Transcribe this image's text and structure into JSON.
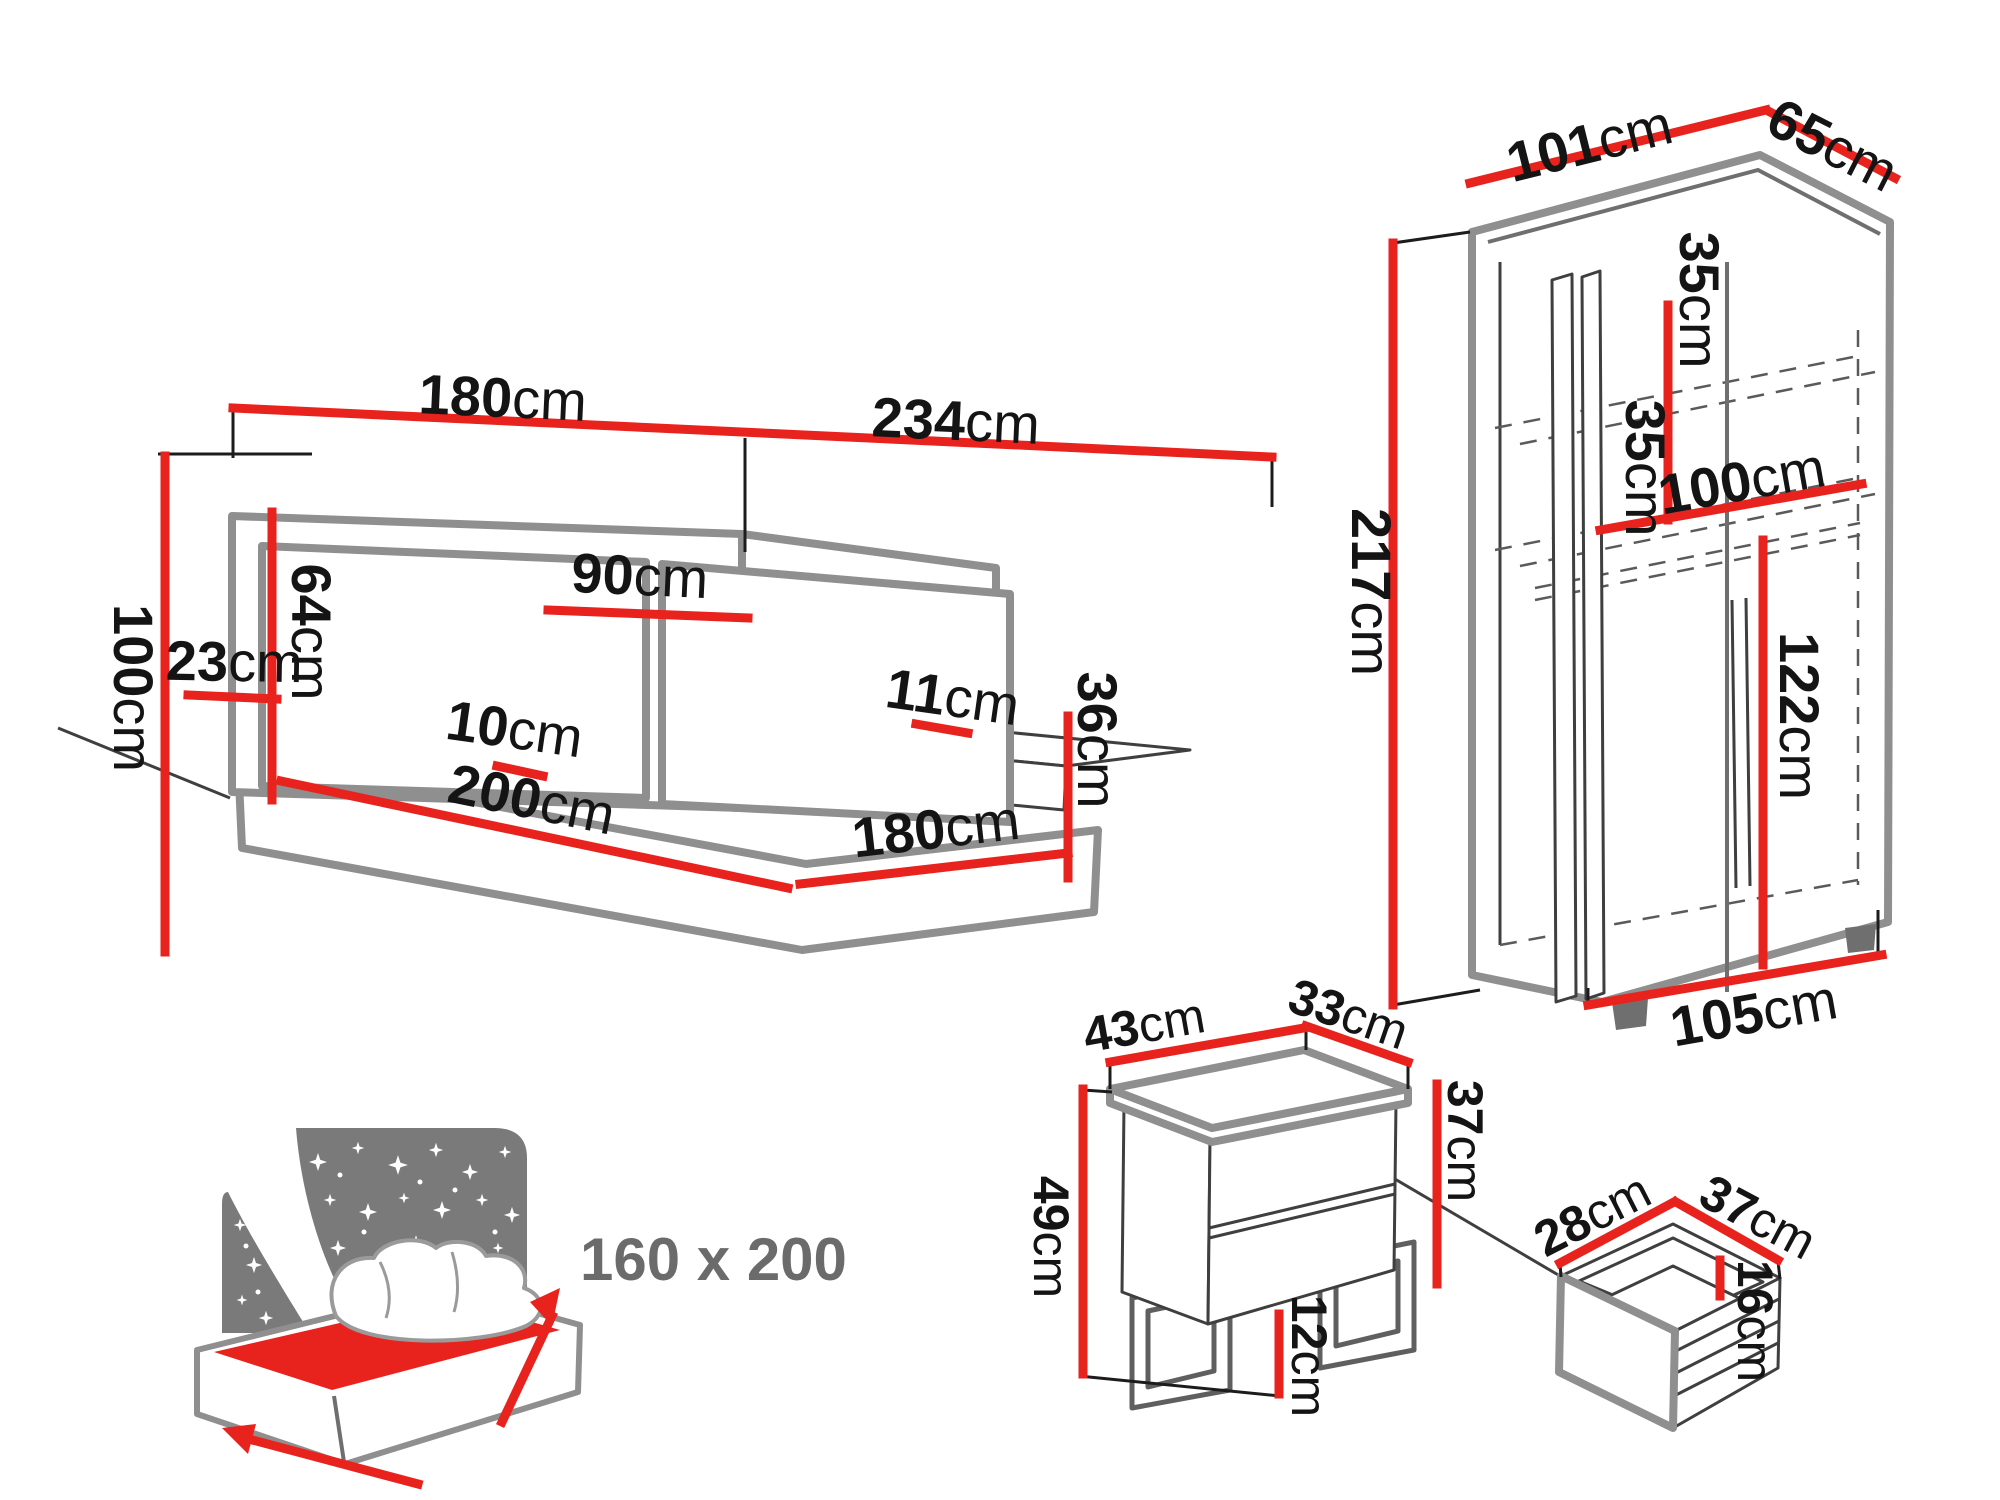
{
  "palette": {
    "dimension_red": "#e8231e",
    "furniture_gray": "#8f8f8f",
    "line_dark": "#3f3f3f",
    "starry_panel_gray": "#7a7a7a",
    "label_black": "#141414",
    "badge_gray": "#6b6b6b",
    "background": "#ffffff"
  },
  "bed": {
    "dims": {
      "width_left": {
        "v": "180",
        "u": "cm"
      },
      "width_right": {
        "v": "234",
        "u": "cm"
      },
      "cushion_width": {
        "v": "90",
        "u": "cm"
      },
      "headboard_upper_height": {
        "v": "64",
        "u": "cm"
      },
      "headboard_lower_height": {
        "v": "23",
        "u": "cm"
      },
      "headboard_total_height": {
        "v": "100",
        "u": "cm"
      },
      "frame_lip": {
        "v": "10",
        "u": "cm"
      },
      "bed_length": {
        "v": "200",
        "u": "cm"
      },
      "mattress_lip": {
        "v": "11",
        "u": "cm"
      },
      "footboard_height": {
        "v": "36",
        "u": "cm"
      },
      "footboard_width": {
        "v": "180",
        "u": "cm"
      }
    }
  },
  "wardrobe": {
    "dims": {
      "top_width": {
        "v": "101",
        "u": "cm"
      },
      "top_depth": {
        "v": "65",
        "u": "cm"
      },
      "height": {
        "v": "217",
        "u": "cm"
      },
      "upper_shelf_gap": {
        "v": "35",
        "u": "cm"
      },
      "lower_shelf_gap": {
        "v": "35",
        "u": "cm"
      },
      "interior_width": {
        "v": "100",
        "u": "cm"
      },
      "hanging_height": {
        "v": "122",
        "u": "cm"
      },
      "bottom_width": {
        "v": "105",
        "u": "cm"
      }
    }
  },
  "nightstand": {
    "dims": {
      "top_width": {
        "v": "43",
        "u": "cm"
      },
      "top_depth": {
        "v": "33",
        "u": "cm"
      },
      "body_height": {
        "v": "37",
        "u": "cm"
      },
      "total_height": {
        "v": "49",
        "u": "cm"
      },
      "leg_height": {
        "v": "12",
        "u": "cm"
      }
    }
  },
  "drawer": {
    "dims": {
      "inner_width": {
        "v": "28",
        "u": "cm"
      },
      "inner_depth": {
        "v": "37",
        "u": "cm"
      },
      "inner_height": {
        "v": "16",
        "u": "cm"
      }
    }
  },
  "bed_size_badge": {
    "label": "160 x 200"
  }
}
